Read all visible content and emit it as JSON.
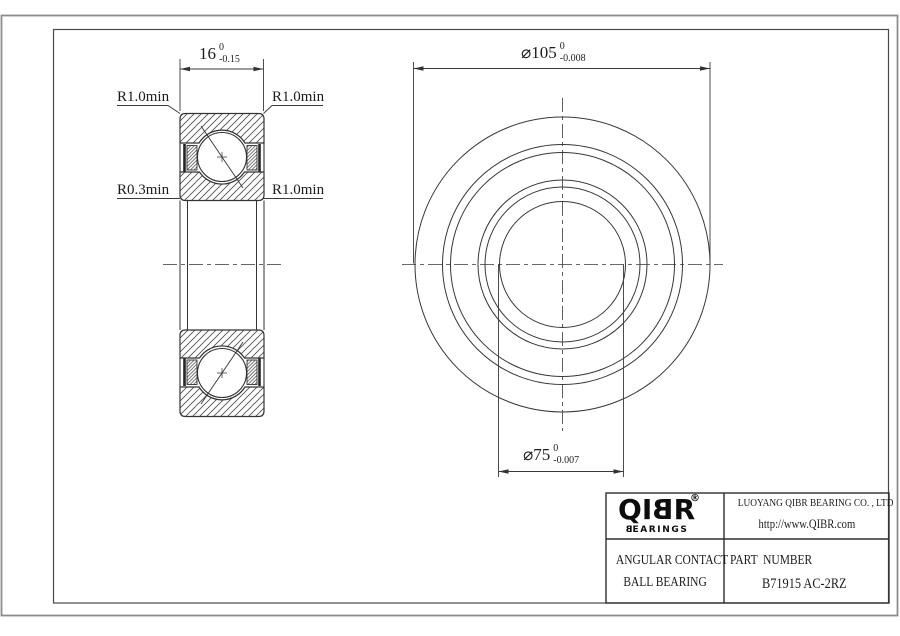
{
  "section_view": {
    "dim_width": {
      "value": "16",
      "tol_upper": "0",
      "tol_lower": "-0.15"
    },
    "radius_labels": {
      "top_left": "R1.0min",
      "top_right": "R1.0min",
      "bottom_left": "R0.3min",
      "bottom_right": "R1.0min"
    }
  },
  "front_view": {
    "dim_outer_diameter": {
      "value": "⌀105",
      "tol_upper": "0",
      "tol_lower": "-0.008"
    },
    "dim_bore_diameter": {
      "value": "⌀75",
      "tol_upper": "0",
      "tol_lower": "-0.007"
    }
  },
  "title_block": {
    "logo": {
      "letters": [
        "Q",
        "I",
        "B",
        "R"
      ],
      "registered": "®",
      "subtitle_first": "B",
      "subtitle_rest": "EARINGS"
    },
    "company_name": "LUOYANG QIBR BEARING CO. , LTD",
    "website": "http://www.QIBR.com",
    "product_type_line1": "ANGULAR CONTACT",
    "product_type_line2": "BALL BEARING",
    "part_number_label": "PART  NUMBER",
    "part_number_value": "B71915 AC-2RZ"
  },
  "colors": {
    "line": "#3a3a3a",
    "outer_frame": "#8c8c8c",
    "inner_frame": "#4a4a4a",
    "text": "#1c1c1c",
    "seal_fill": "#262626"
  }
}
